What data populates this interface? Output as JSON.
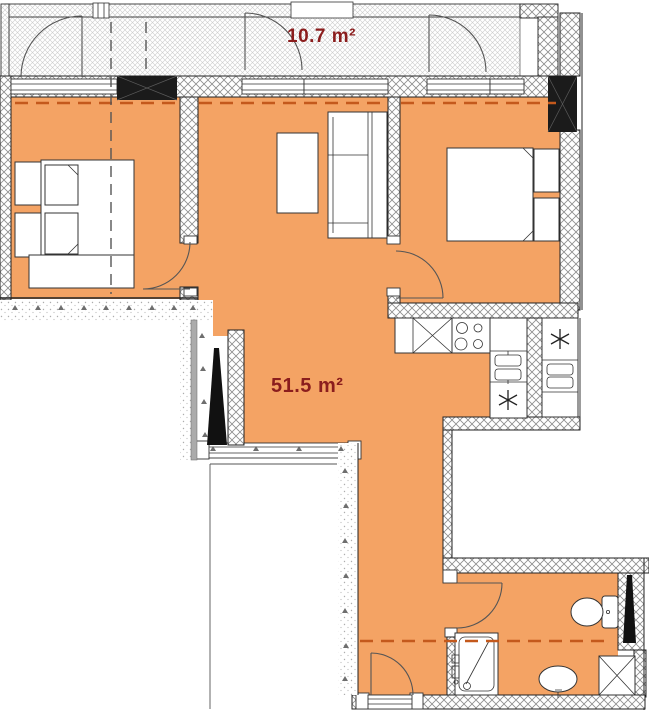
{
  "labels": {
    "balcony_area": "10.7 m²",
    "apartment_area": "51.5 m²"
  },
  "colors": {
    "floor": "#F4A364",
    "accent_dash": "#C4591C",
    "area_label": "#8B1D1D",
    "structure_black": "#1b1b1b"
  }
}
